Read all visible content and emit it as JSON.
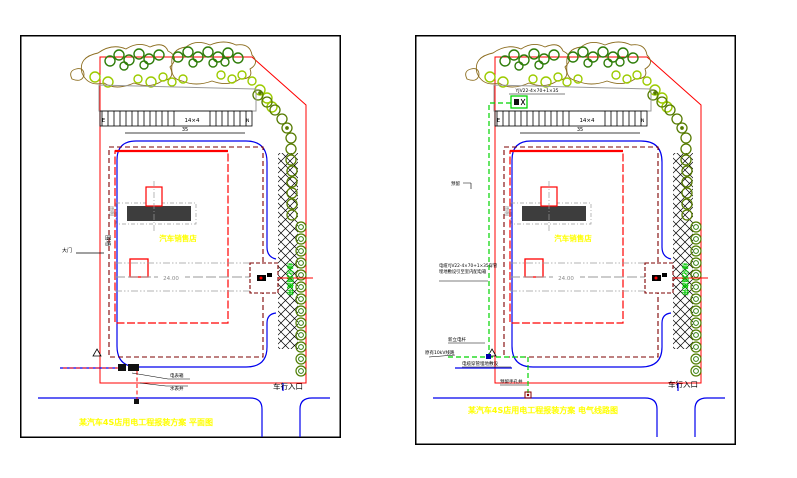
{
  "app": {
    "type": "cad-site-plan-drawing",
    "background": "#ffffff",
    "panel_count": 2
  },
  "colors": {
    "boundary_red": "#ff0000",
    "setback_maroon": "#7e0000",
    "road_blue": "#0000ee",
    "centerline_gray": "#9a9a9a",
    "tree_dark_green": "#2f7d0a",
    "tree_light_green": "#9ccb00",
    "tree_olive": "#55,7a00",
    "shrub_brown": "#8c6d1f",
    "hedge_green": "#4f7d00",
    "cable_green": "#00d400",
    "label_yellow": "#ffff00",
    "canopy_fill": "#3d3d3d"
  },
  "left_panel": {
    "title": "某汽车4S店用电工程报装方案 平面图",
    "building_label": "汽车销售店",
    "centerline_value": "24.00",
    "parking_label": "14×4",
    "parking_left_mark": "E",
    "parking_right_mark": "N",
    "dim_value": "35",
    "hedge_label": "绿化隔离带",
    "vehicle_entrance_label": "车行入口",
    "boundary_label": "围墙",
    "gate_label": "大门",
    "meter_label": "电表箱",
    "water_label": "水表井",
    "canopy_label": "雨棚"
  },
  "right_panel": {
    "title": "某汽车4S店用电工程报装方案 电气线路图",
    "building_label": "汽车销售店",
    "centerline_value": "24.00",
    "parking_label": "14×4",
    "parking_left_mark": "E",
    "parking_right_mark": "N",
    "dim_value": "35",
    "hedge_label": "绿化隔离带",
    "vehicle_entrance_label": "车行入口",
    "canopy_label": "雨棚",
    "reserve_label": "预留",
    "cable_spec": "YJV22-4×70+1×35",
    "cable_note_line1": "电缆YJV22-4×70+1×35穿管",
    "cable_note_line2": "埋地敷设引至室内配电箱",
    "pole_label": "新立电杆",
    "line_label": "原有10kV线路",
    "duct_label": "电缆穿管埋地敷设",
    "handhole_label": "预留手孔井"
  }
}
